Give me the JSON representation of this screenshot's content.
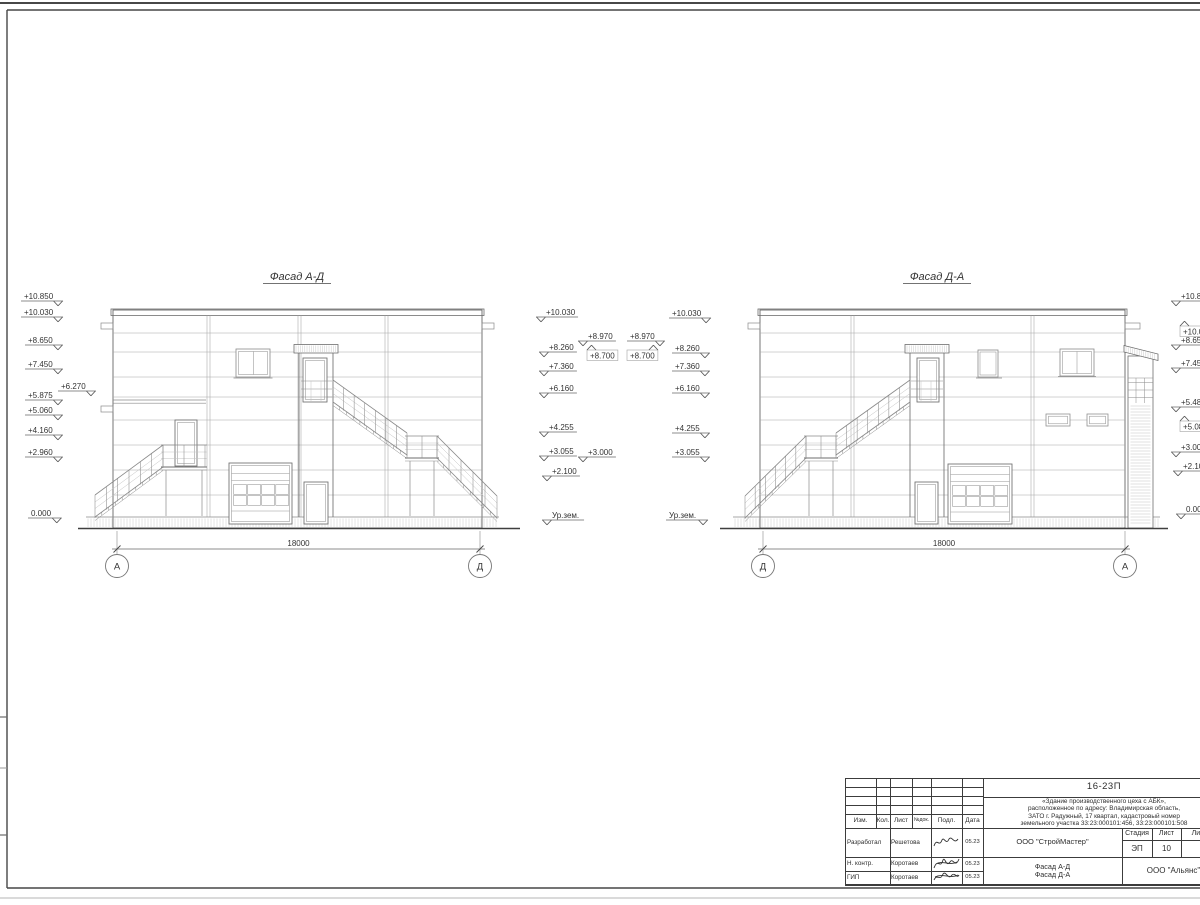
{
  "facade_titles": [
    {
      "text": "Фасад А-Д",
      "cx": 297,
      "y": 280
    },
    {
      "text": "Фасад Д-А",
      "cx": 937,
      "y": 280
    }
  ],
  "ground_level_label": "Ур.зем.",
  "elevation_marks": [
    {
      "t": "+10.850",
      "x": 24,
      "y": 301,
      "sym": "right",
      "dir": "down"
    },
    {
      "t": "+10.030",
      "x": 24,
      "y": 317,
      "sym": "right",
      "dir": "down"
    },
    {
      "t": "+8.650",
      "x": 28,
      "y": 345,
      "sym": "right",
      "dir": "down"
    },
    {
      "t": "+7.450",
      "x": 28,
      "y": 369,
      "sym": "right",
      "dir": "down"
    },
    {
      "t": "+6.270",
      "x": 61,
      "y": 391,
      "sym": "right",
      "dir": "down"
    },
    {
      "t": "+5.875",
      "x": 28,
      "y": 400,
      "sym": "right",
      "dir": "down"
    },
    {
      "t": "+5.060",
      "x": 28,
      "y": 415,
      "sym": "right",
      "dir": "down"
    },
    {
      "t": "+4.160",
      "x": 28,
      "y": 435,
      "sym": "right",
      "dir": "down"
    },
    {
      "t": "+2.960",
      "x": 28,
      "y": 457,
      "sym": "right",
      "dir": "down"
    },
    {
      "t": "0.000",
      "x": 31,
      "y": 518,
      "sym": "right",
      "dir": "down"
    },
    {
      "t": "+10.030",
      "x": 546,
      "y": 317,
      "sym": "left",
      "dir": "down"
    },
    {
      "t": "+8.260",
      "x": 549,
      "y": 352,
      "sym": "left",
      "dir": "down"
    },
    {
      "t": "+7.360",
      "x": 549,
      "y": 371,
      "sym": "left",
      "dir": "down"
    },
    {
      "t": "+6.160",
      "x": 549,
      "y": 393,
      "sym": "left",
      "dir": "down"
    },
    {
      "t": "+4.255",
      "x": 549,
      "y": 432,
      "sym": "left",
      "dir": "down"
    },
    {
      "t": "+3.055",
      "x": 549,
      "y": 456,
      "sym": "left",
      "dir": "down"
    },
    {
      "t": "+2.100",
      "x": 552,
      "y": 476,
      "sym": "left",
      "dir": "down"
    },
    {
      "t": "Ур.зем.",
      "x": 552,
      "y": 520,
      "sym": "left",
      "dir": "down"
    },
    {
      "t": "+8.970",
      "x": 588,
      "y": 341,
      "sym": "left",
      "dir": "down"
    },
    {
      "t": "+8.700",
      "x": 590,
      "y": 350,
      "sym": "left",
      "dir": "up"
    },
    {
      "t": "+8.970",
      "x": 630,
      "y": 341,
      "sym": "right",
      "dir": "down"
    },
    {
      "t": "+8.700",
      "x": 630,
      "y": 350,
      "sym": "right",
      "dir": "up"
    },
    {
      "t": "+3.000",
      "x": 588,
      "y": 457,
      "sym": "left",
      "dir": "down"
    },
    {
      "t": "+10.030",
      "x": 672,
      "y": 318,
      "sym": "right",
      "dir": "down"
    },
    {
      "t": "+8.260",
      "x": 675,
      "y": 353,
      "sym": "right",
      "dir": "down"
    },
    {
      "t": "+7.360",
      "x": 675,
      "y": 371,
      "sym": "right",
      "dir": "down"
    },
    {
      "t": "+6.160",
      "x": 675,
      "y": 393,
      "sym": "right",
      "dir": "down"
    },
    {
      "t": "+4.255",
      "x": 675,
      "y": 433,
      "sym": "right",
      "dir": "down"
    },
    {
      "t": "+3.055",
      "x": 675,
      "y": 457,
      "sym": "right",
      "dir": "down"
    },
    {
      "t": "Ур.зем.",
      "x": 669,
      "y": 520,
      "sym": "right",
      "dir": "down"
    },
    {
      "t": "+10.850",
      "x": 1181,
      "y": 301,
      "sym": "left",
      "dir": "down"
    },
    {
      "t": "+10.030",
      "x": 1183,
      "y": 326,
      "sym": "left",
      "dir": "up"
    },
    {
      "t": "+8.650",
      "x": 1181,
      "y": 345,
      "sym": "left",
      "dir": "down"
    },
    {
      "t": "+7.450",
      "x": 1181,
      "y": 368,
      "sym": "left",
      "dir": "down"
    },
    {
      "t": "+5.485",
      "x": 1181,
      "y": 407,
      "sym": "left",
      "dir": "down"
    },
    {
      "t": "+5.080",
      "x": 1183,
      "y": 421,
      "sym": "left",
      "dir": "up"
    },
    {
      "t": "+3.000",
      "x": 1181,
      "y": 452,
      "sym": "left",
      "dir": "down"
    },
    {
      "t": "+2.100",
      "x": 1183,
      "y": 471,
      "sym": "left",
      "dir": "down"
    },
    {
      "t": "0.000",
      "x": 1186,
      "y": 514,
      "sym": "left",
      "dir": "down"
    }
  ],
  "dimensions": [
    {
      "x1": 117,
      "x2": 480,
      "y": 549,
      "label": "18000",
      "axes": [
        {
          "label": "А",
          "x": 117
        },
        {
          "label": "Д",
          "x": 480
        }
      ]
    },
    {
      "x1": 763,
      "x2": 1125,
      "y": 549,
      "label": "18000",
      "axes": [
        {
          "label": "Д",
          "x": 763
        },
        {
          "label": "А",
          "x": 1125
        }
      ]
    }
  ],
  "title_block": {
    "doc_number": "16-23П",
    "project_description_lines": [
      "«Здание производственного цеха с АБК»,",
      "расположенное по адресу: Владимирская область,",
      "ЗАТО г. Радужный, 17 квартал, кадастровый номер",
      "земельного участка 33:23:000101:456, 33:23:000101:508"
    ],
    "designer_org": "ООО \"СтройМастер\"",
    "customer_org": "ООО \"Альянс\"",
    "sheet_title_lines": [
      "Фасад А-Д",
      "Фасад Д-А"
    ],
    "header_columns": [
      "Изм.",
      "Кол.",
      "Лист",
      "№док.",
      "Подл.",
      "Дата"
    ],
    "stage_table": {
      "headers": [
        "Стадия",
        "Лист",
        "Листов"
      ],
      "values": [
        "ЭП",
        "10",
        "1"
      ]
    },
    "personnel": [
      {
        "role": "Разработал",
        "name": "Решетова",
        "date": "05.23"
      },
      {
        "role": "Н. контр.",
        "name": "Коротаев",
        "date": "05.23"
      },
      {
        "role": "ГИП",
        "name": "Коротаев",
        "date": "05.23"
      }
    ]
  }
}
